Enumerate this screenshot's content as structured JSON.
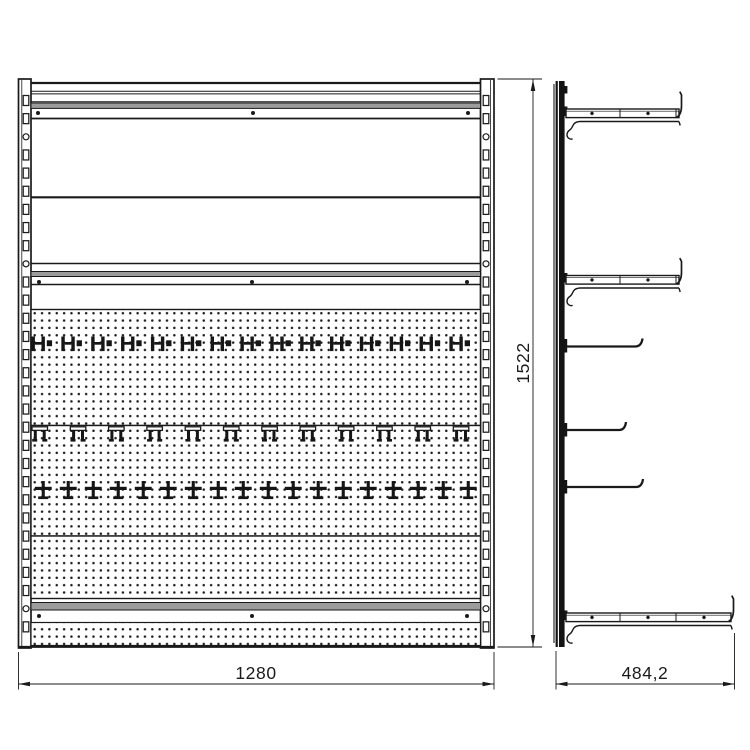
{
  "dimension_labels": {
    "front_width": "1280",
    "front_height": "1522",
    "side_depth": "484,2"
  },
  "colors": {
    "line": "#1a1a1a",
    "rail_gray": "#9c9c9c",
    "hook_fill": "#161616",
    "background": "#ffffff",
    "peg_dot": "#1f1f1f"
  }
}
